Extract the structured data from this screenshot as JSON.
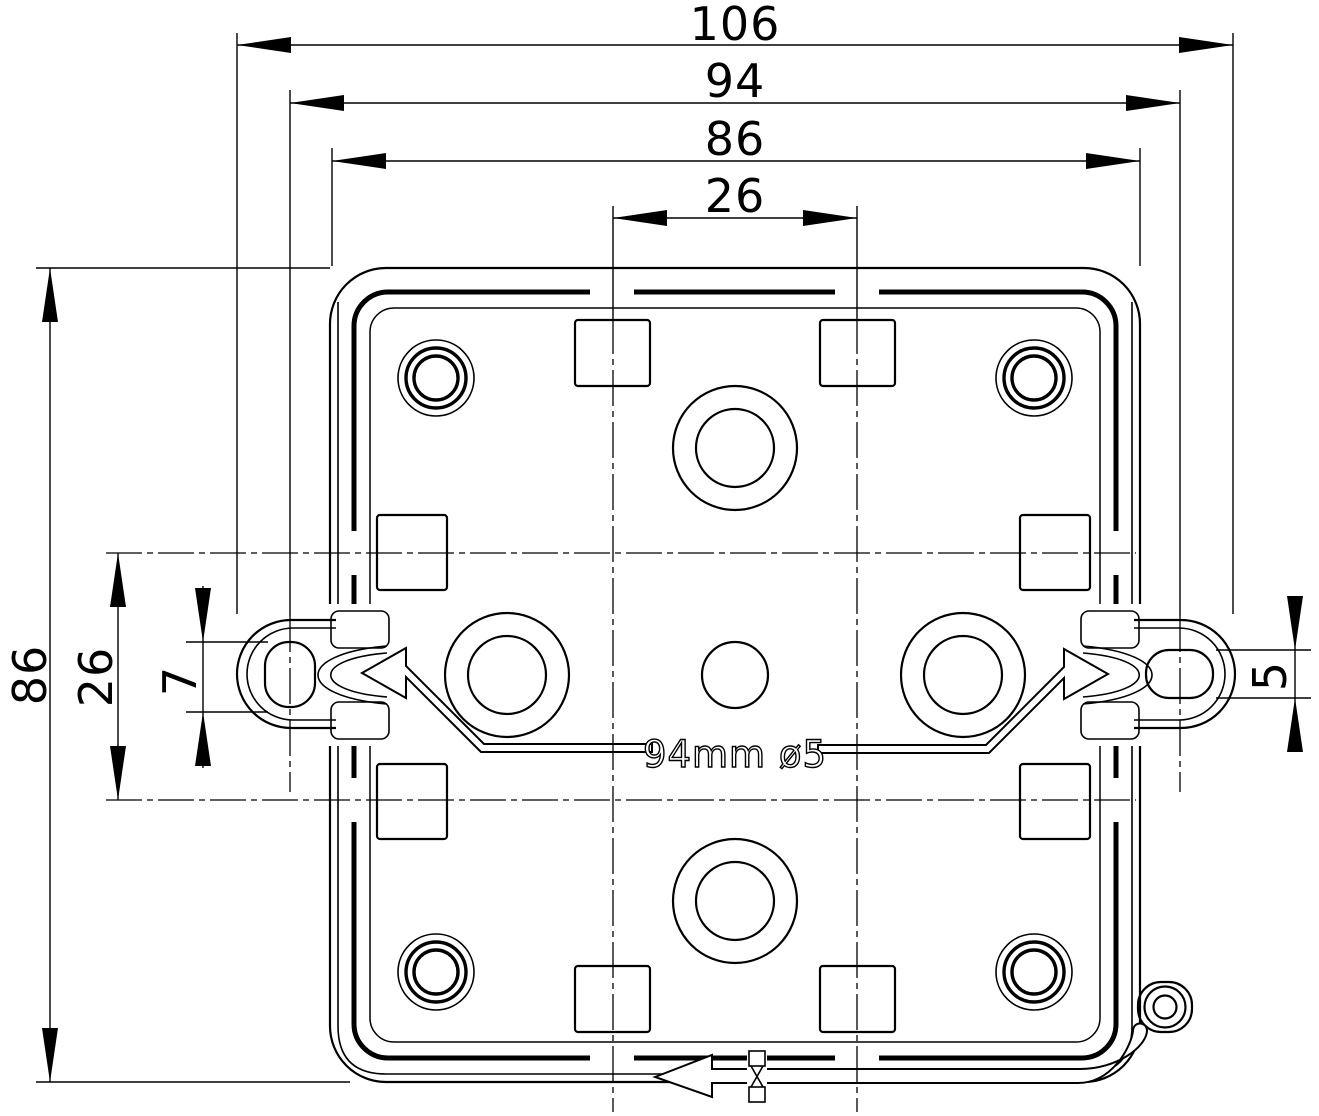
{
  "drawing": {
    "type": "technical-drawing",
    "subject": "square junction box rear view with mounting tabs",
    "colors": {
      "line": "#000000",
      "background": "#ffffff"
    },
    "dims": {
      "top": {
        "d106": "106",
        "d94": "94",
        "d86": "86",
        "d26": "26"
      },
      "left": {
        "d86": "86",
        "d26": "26",
        "d7": "7"
      },
      "right": {
        "d5": "5"
      },
      "note": "94mm ø5"
    }
  }
}
